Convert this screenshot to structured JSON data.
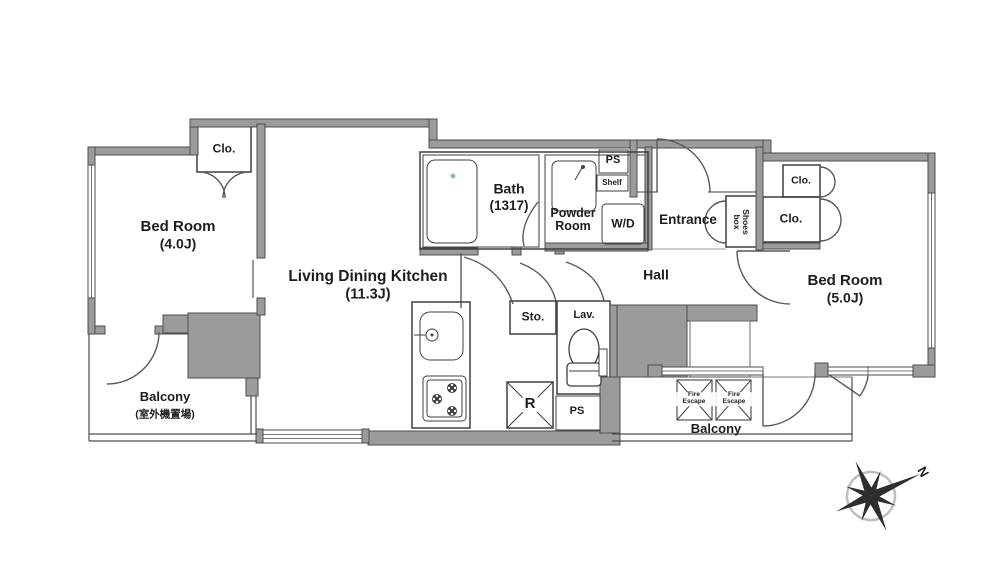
{
  "plan": {
    "rooms": {
      "bedroom_left": {
        "name": "Bed Room",
        "size": "(4.0J)"
      },
      "ldk": {
        "name": "Living Dining Kitchen",
        "size": "(11.3J)"
      },
      "bath": {
        "name": "Bath",
        "size": "(1317)"
      },
      "powder_room": {
        "name": "Powder Room"
      },
      "entrance": {
        "name": "Entrance"
      },
      "hall": {
        "name": "Hall"
      },
      "bedroom_right": {
        "name": "Bed Room",
        "size": "(5.0J)"
      },
      "balcony_left": {
        "name": "Balcony",
        "note": "(室外機置場)"
      },
      "balcony_right": {
        "name": "Balcony"
      }
    },
    "fixtures": {
      "closet_top_left": "Clo.",
      "closet_right_upper": "Clo.",
      "closet_right_lower": "Clo.",
      "shoes_box": "Shoes box",
      "shelf": "Shelf",
      "washer_dryer": "W/D",
      "pipe_space_top": "PS",
      "pipe_space_bottom": "PS",
      "storage": "Sto.",
      "lavatory": "Lav.",
      "refrigerator": "R",
      "fire_escape_left": "Fire Escape",
      "fire_escape_right": "Fire Escape"
    },
    "compass": {
      "north": "N"
    },
    "colors": {
      "closet_pink": "#f8d8e4",
      "wet_blue": "#cde9f6",
      "wall_gray": "#9b9b9b",
      "outline": "#4a4a4a"
    }
  }
}
